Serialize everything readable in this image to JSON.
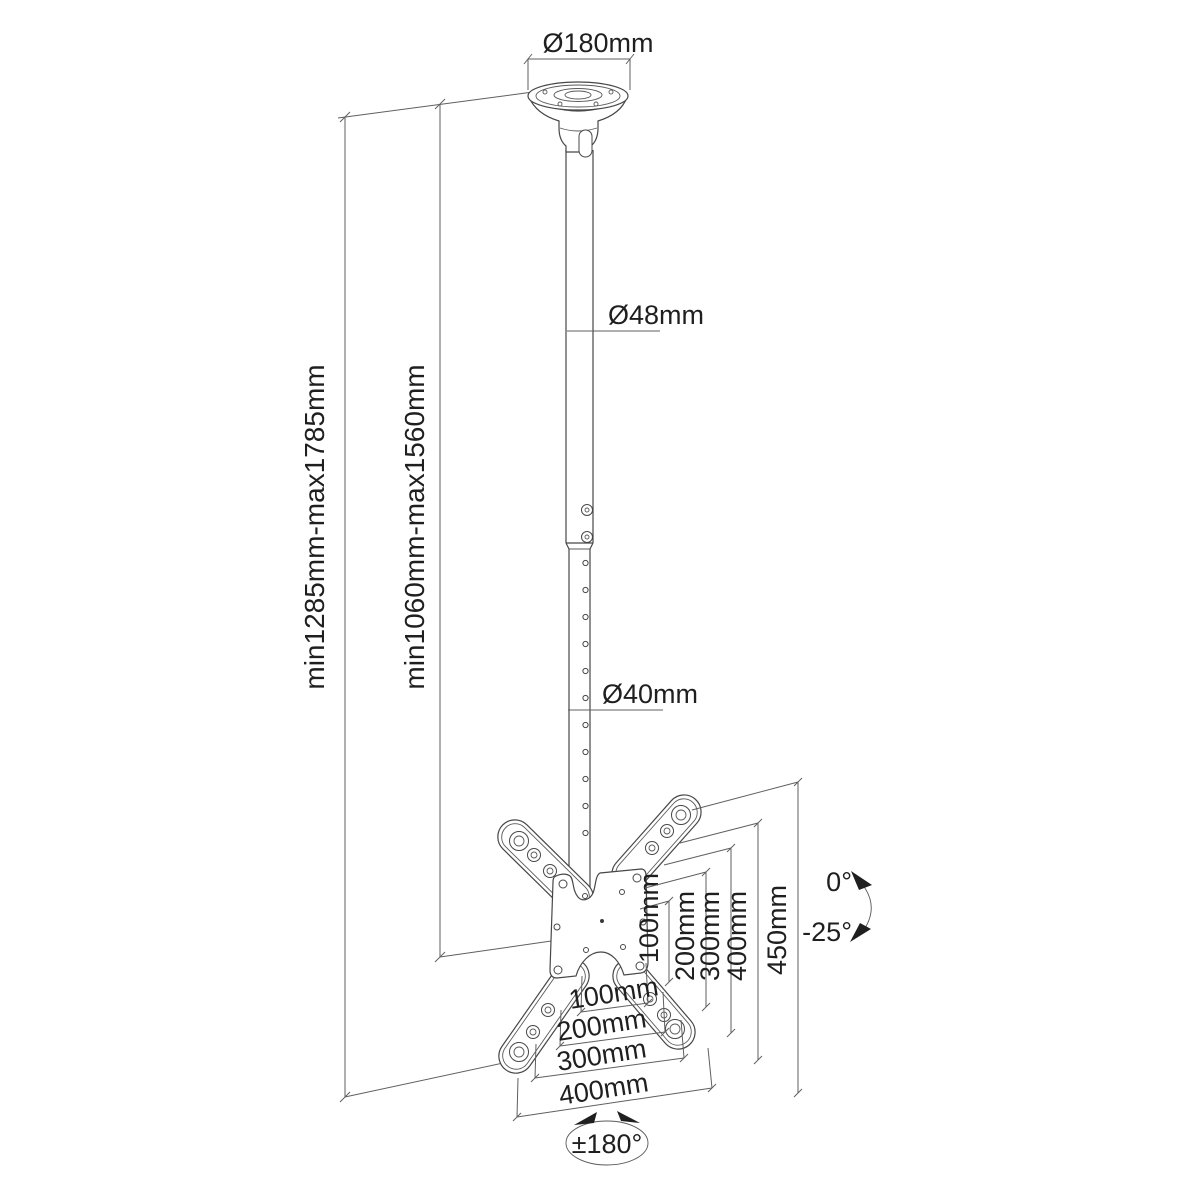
{
  "diagram": {
    "type": "technical-dimension-drawing",
    "subject": "tv-ceiling-mount",
    "colors": {
      "background": "#ffffff",
      "line": "#474747",
      "dimension_line": "#5f5f5f",
      "text": "#1f1f1f"
    },
    "dimensions": {
      "ceiling_plate_diameter": "Ø180mm",
      "upper_pole_diameter": "Ø48mm",
      "lower_pole_diameter": "Ø40mm",
      "overall_height_range": "min1285mm-max1785mm",
      "pole_height_range": "min1060mm-max1560mm",
      "vesa_vertical": [
        "100mm",
        "200mm",
        "300mm",
        "400mm",
        "450mm"
      ],
      "vesa_horizontal": [
        "100mm",
        "200mm",
        "300mm",
        "400mm"
      ],
      "tilt_max": "0°",
      "tilt_min": "-25°",
      "swivel_range": "±180°"
    }
  }
}
